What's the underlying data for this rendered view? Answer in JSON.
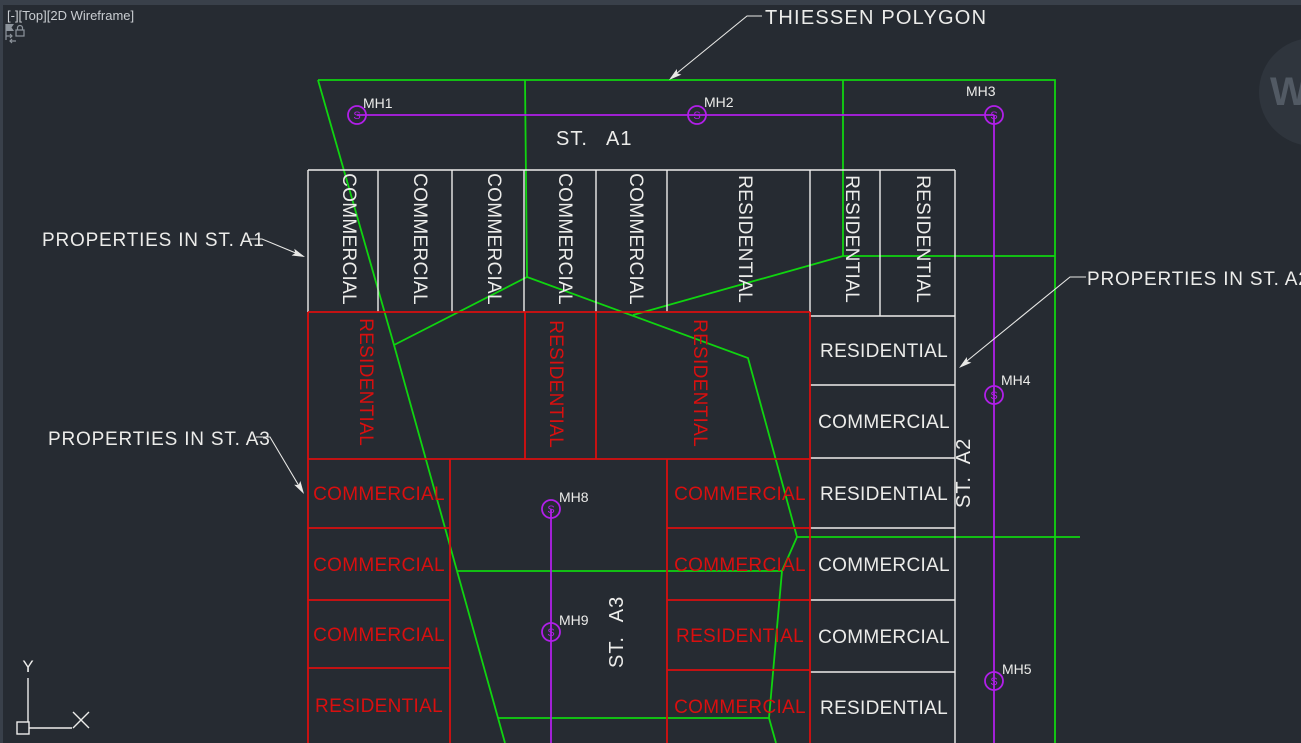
{
  "chrome": {
    "viewport_label": "[-][Top][2D Wireframe]",
    "watermark_letter": "W"
  },
  "annotations": {
    "thiessen_label": "THIESSEN POLYGON",
    "properties_st_a1": "PROPERTIES IN ST. A1",
    "properties_st_a2": "PROPERTIES IN ST. A2",
    "properties_st_a3": "PROPERTIES IN ST. A3"
  },
  "streets": {
    "a1": {
      "prefix": "ST.",
      "name": "A1"
    },
    "a2": {
      "prefix": "ST.",
      "name": "A2"
    },
    "a3": {
      "prefix": "ST.",
      "name": "A3"
    }
  },
  "manholes": [
    {
      "id": "MH1",
      "symbol": "S"
    },
    {
      "id": "MH2",
      "symbol": "S"
    },
    {
      "id": "MH3",
      "symbol": "S"
    },
    {
      "id": "MH4",
      "symbol": "S"
    },
    {
      "id": "MH5",
      "symbol": "S"
    },
    {
      "id": "MH8",
      "symbol": "S"
    },
    {
      "id": "MH9",
      "symbol": "S"
    }
  ],
  "parcels": {
    "top_row": [
      "COMMERCIAL",
      "COMMERCIAL",
      "COMMERCIAL",
      "COMMERCIAL",
      "COMMERCIAL",
      "RESIDENTIAL",
      "RESIDENTIAL",
      "RESIDENTIAL"
    ],
    "row2": [
      "RESIDENTIAL",
      "RESIDENTIAL",
      "RESIDENTIAL"
    ],
    "left_col": [
      "COMMERCIAL",
      "COMMERCIAL",
      "COMMERCIAL",
      "RESIDENTIAL"
    ],
    "mid_col": [
      "COMMERCIAL",
      "COMMERCIAL",
      "RESIDENTIAL",
      "COMMERCIAL"
    ],
    "right_col": [
      "RESIDENTIAL",
      "COMMERCIAL",
      "RESIDENTIAL",
      "COMMERCIAL",
      "COMMERCIAL",
      "RESIDENTIAL"
    ]
  },
  "ucs": {
    "x_label": "X",
    "y_label": "Y"
  },
  "colors": {
    "background": "#262B32",
    "green": "#10D410",
    "red": "#D90F0F",
    "purple": "#B11FE9",
    "white_lines": "#EDEDEB",
    "chrome_edge": "#39404A"
  }
}
